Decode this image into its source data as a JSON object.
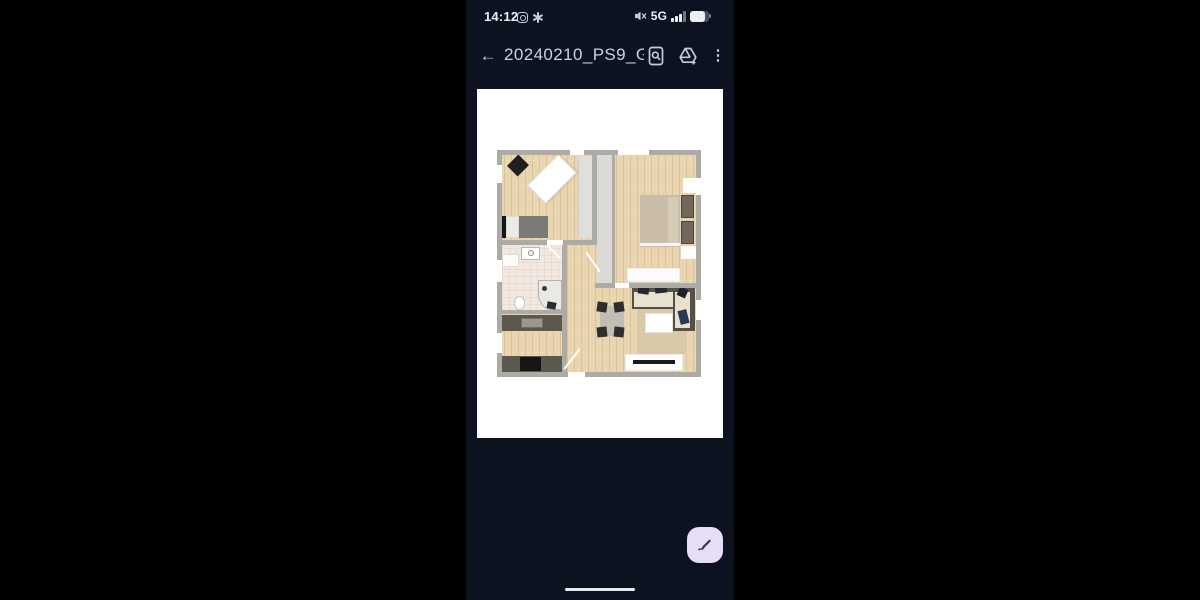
{
  "status_bar": {
    "time": "14:12",
    "network": "5G"
  },
  "header": {
    "title": "20240210_PS9_G...",
    "back_glyph": "←",
    "menu_glyph": "⋮"
  },
  "icons": {
    "left_notifications": [
      "instagram-icon",
      "asterisk-app-icon"
    ],
    "right_status": [
      "volume-muted-icon",
      "signal-bars-icon",
      "battery-icon"
    ],
    "header_actions": [
      "document-scan-icon",
      "drive-add-icon",
      "kebab-menu-icon"
    ],
    "fab": "edit-pen-icon"
  },
  "photo": {
    "type": "floor-plan-image"
  },
  "colors": {
    "outer-bg": "#000000",
    "screen-bg": "#0d1220",
    "card-bg": "#ffffff",
    "title-color": "#cdd2e0",
    "icon-color": "#c6cbd8",
    "status-color": "#edeff4",
    "fab-bg": "#e5def6",
    "fab-icon": "#39324e",
    "wall": "#adaba6",
    "wood": "#e9d6b0",
    "bath-floor": "#f3e8e0",
    "counter": "#5b584d",
    "rug": "#dac9a9",
    "sofa-cushion": "#e9e1cf",
    "bed-beige": "#c9bca8"
  }
}
